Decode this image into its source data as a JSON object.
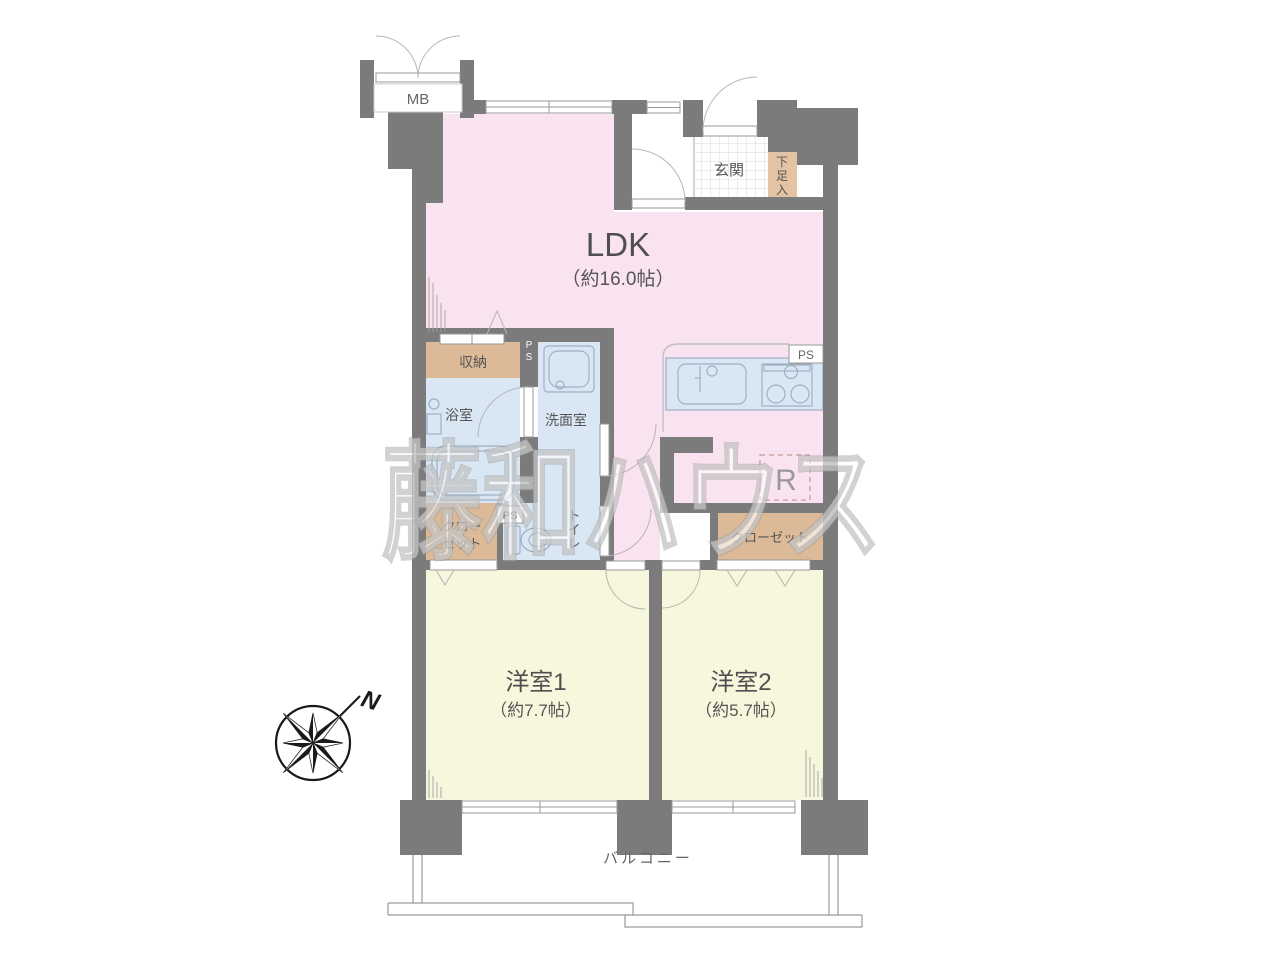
{
  "watermark": "藤和ハウス",
  "compass": {
    "north_label": "N"
  },
  "rooms": {
    "ldk": {
      "name": "LDK",
      "size": "（約16.0帖）"
    },
    "bedroom1": {
      "name": "洋室1",
      "size": "（約7.7帖）"
    },
    "bedroom2": {
      "name": "洋室2",
      "size": "（約5.7帖）"
    },
    "entrance": {
      "label": "玄関"
    },
    "shoe_cabinet": {
      "chars": [
        "下",
        "足",
        "入"
      ]
    },
    "meter_box": {
      "label": "MB"
    },
    "storage": {
      "label": "収納"
    },
    "bathroom": {
      "label": "浴室"
    },
    "washroom": {
      "label": "洗面室"
    },
    "toilet": {
      "chars": [
        "ト",
        "イ",
        "レ"
      ]
    },
    "closet_left": {
      "lines": [
        "クロー",
        "ゼット"
      ]
    },
    "closet_right": {
      "label": "クローゼット"
    },
    "balcony": {
      "label": "バルコニー"
    },
    "pipe_space_kitchen": {
      "label": "PS"
    },
    "pipe_space_wash": {
      "chars": [
        "P",
        "S"
      ]
    },
    "pipe_space_toilet": {
      "label": "PS"
    },
    "refrigerator": {
      "label": "R"
    }
  },
  "colors": {
    "wall": "#7b7b7b",
    "ldk_fill": "#fae3f0",
    "bedroom_fill": "#f7f7dd",
    "wet_area_fill": "#d9e7f5",
    "closet_fill": "#dcba97",
    "shoe_fill": "#e3c3a4",
    "watermark_text": "#ffffff",
    "refrigerator_dash": "#c49a9a"
  }
}
